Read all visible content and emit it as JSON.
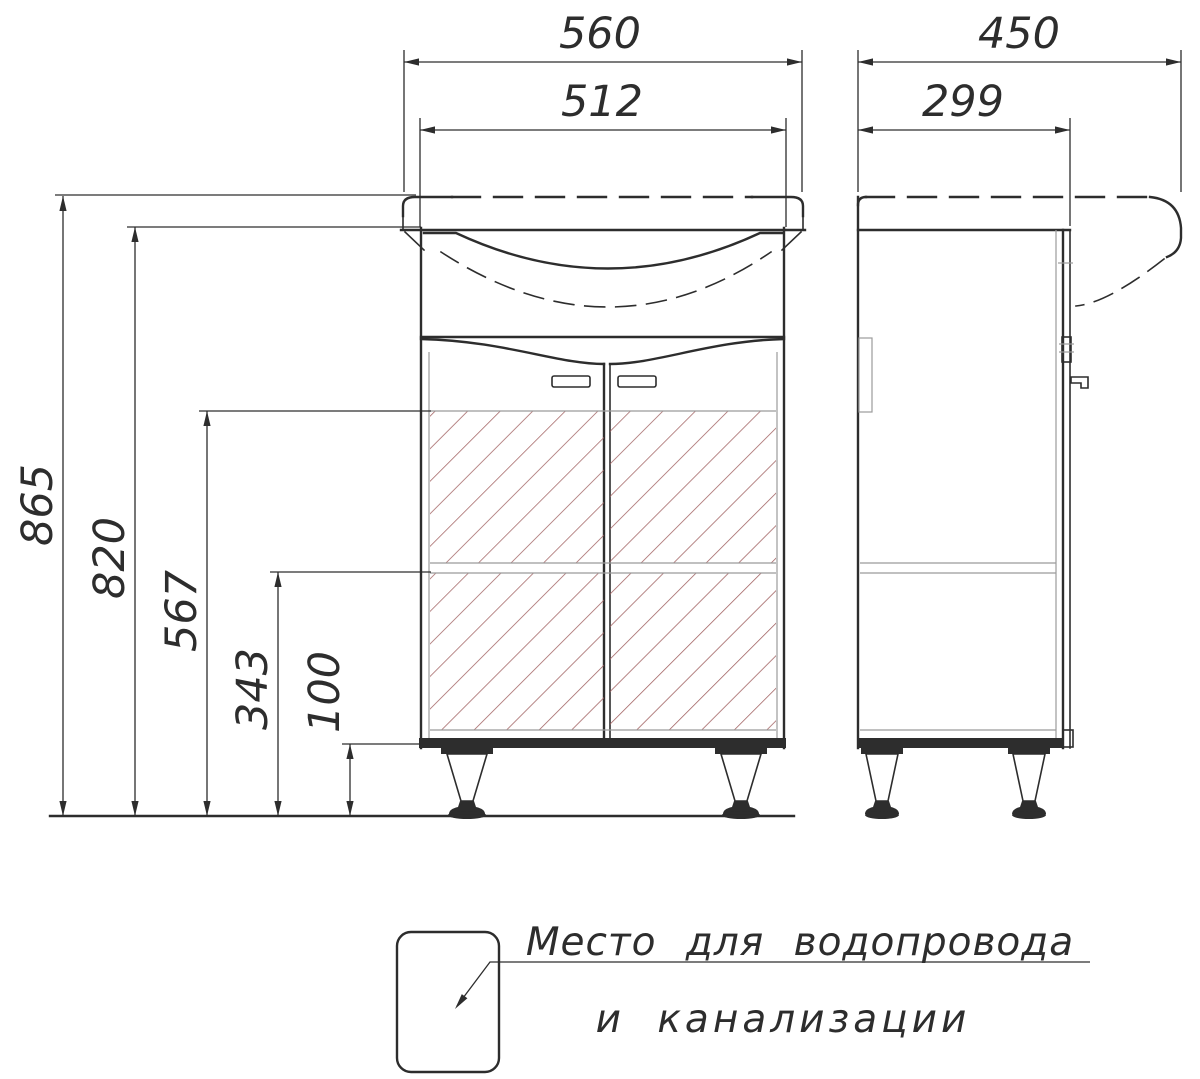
{
  "dims": {
    "front": {
      "overall_width": "560",
      "cabinet_width": "512",
      "overall_height": "865",
      "cabinet_height": "820",
      "plumbing_zone_height": "567",
      "shelf_height": "343",
      "leg_height": "100"
    },
    "side": {
      "overall_depth": "450",
      "cabinet_depth": "299"
    }
  },
  "legend": {
    "label_line1": "Место для водопровода",
    "label_line2": "и канализации"
  },
  "colors": {
    "line": "#2d2d2d",
    "thin_line": "#9b9b9b",
    "hatch": "#a05f5f",
    "background": "#ffffff"
  }
}
